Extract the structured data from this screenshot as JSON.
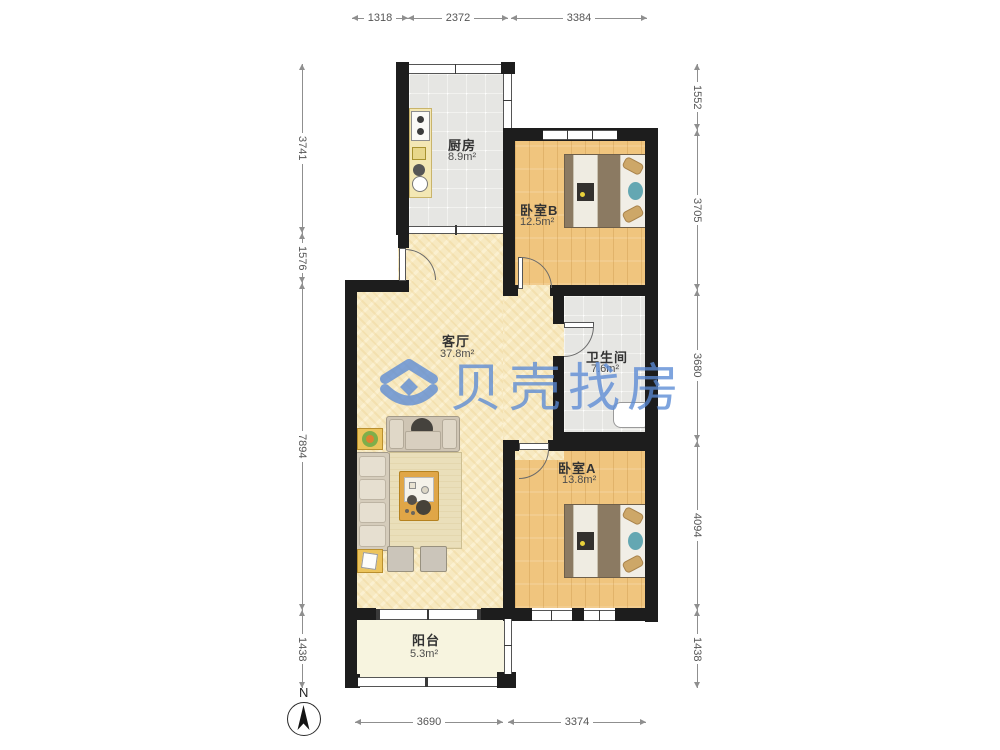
{
  "watermark": {
    "text": "贝壳找房",
    "logo": "beike-shell-house-logo",
    "color": "#5b8bd5"
  },
  "compass": {
    "label": "N"
  },
  "rooms": {
    "kitchen": {
      "name": "厨房",
      "area": "8.9m²"
    },
    "bedroom_b": {
      "name": "卧室B",
      "area": "12.5m²"
    },
    "living": {
      "name": "客厅",
      "area": "37.8m²"
    },
    "bathroom": {
      "name": "卫生间",
      "area": "7.6m²"
    },
    "bedroom_a": {
      "name": "卧室A",
      "area": "13.8m²"
    },
    "balcony": {
      "name": "阳台",
      "area": "5.3m²"
    }
  },
  "dimensions": {
    "top": [
      "1318",
      "2372",
      "3384"
    ],
    "left": [
      "3741",
      "1576",
      "7894",
      "1438"
    ],
    "right": [
      "1552",
      "3705",
      "3680",
      "4094",
      "1438"
    ],
    "bottom": [
      "3690",
      "3374"
    ]
  },
  "colors": {
    "wall": "#1d1d1d",
    "wood_floor": "#f0c57e",
    "tile_floor": "#e6e6e3",
    "living_floor": "#f7e9c1",
    "balcony_floor": "#f7f4df",
    "watermark_blue": "#5b8bd5"
  }
}
